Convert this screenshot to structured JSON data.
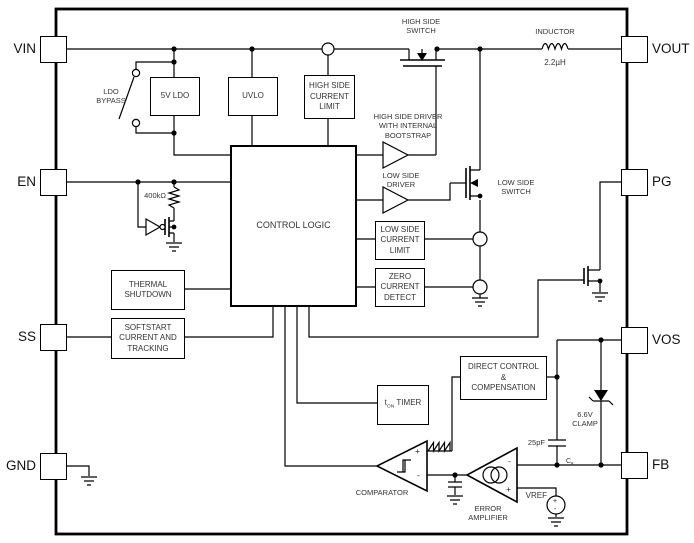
{
  "colors": {
    "line": "#000000",
    "background": "#ffffff"
  },
  "pins": {
    "vin": "VIN",
    "en": "EN",
    "ss": "SS",
    "gnd": "GND",
    "vout": "VOUT",
    "pg": "PG",
    "vos": "VOS",
    "fb": "FB"
  },
  "blocks": {
    "ldo": "5V LDO",
    "uvlo": "UVLO",
    "hs_current_limit": "HIGH SIDE\nCURRENT\nLIMIT",
    "control_logic": "CONTROL LOGIC",
    "ls_current_limit": "LOW SIDE\nCURRENT\nLIMIT",
    "zero_current_detect": "ZERO\nCURRENT\nDETECT",
    "thermal_shutdown": "THERMAL\nSHUTDOWN",
    "softstart": "SOFTSTART\nCURRENT AND\nTRACKING",
    "direct_control": "DIRECT CONTROL\n&\nCOMPENSATION",
    "timer": {
      "base": "t",
      "sub": "ON",
      "rest": " TIMER"
    }
  },
  "labels": {
    "hs_switch": "HIGH SIDE\nSWITCH",
    "inductor": "INDUCTOR",
    "inductor_value": "2.2µH",
    "ldo_bypass": "LDO\nBYPASS",
    "hs_driver": "HIGH SIDE DRIVER\nWITH INTERNAL BOOTSTRAP",
    "ls_driver": "LOW SIDE\nDRIVER",
    "ls_switch": "LOW SIDE\nSWITCH",
    "resistor_value": "400kΩ",
    "clamp": "6.6V\nCLAMP",
    "cap_value": "25pF",
    "cap_name": {
      "base": "C",
      "sub": "ff"
    },
    "comparator": "COMPARATOR",
    "error_amplifier": "ERROR\nAMPLIFIER",
    "vref": "VREF"
  },
  "signs": {
    "comparator_plus": "+",
    "comparator_minus": "-",
    "erramp_minus": "-",
    "erramp_plus": "+",
    "vref_plus": "+",
    "vref_minus": "-"
  }
}
